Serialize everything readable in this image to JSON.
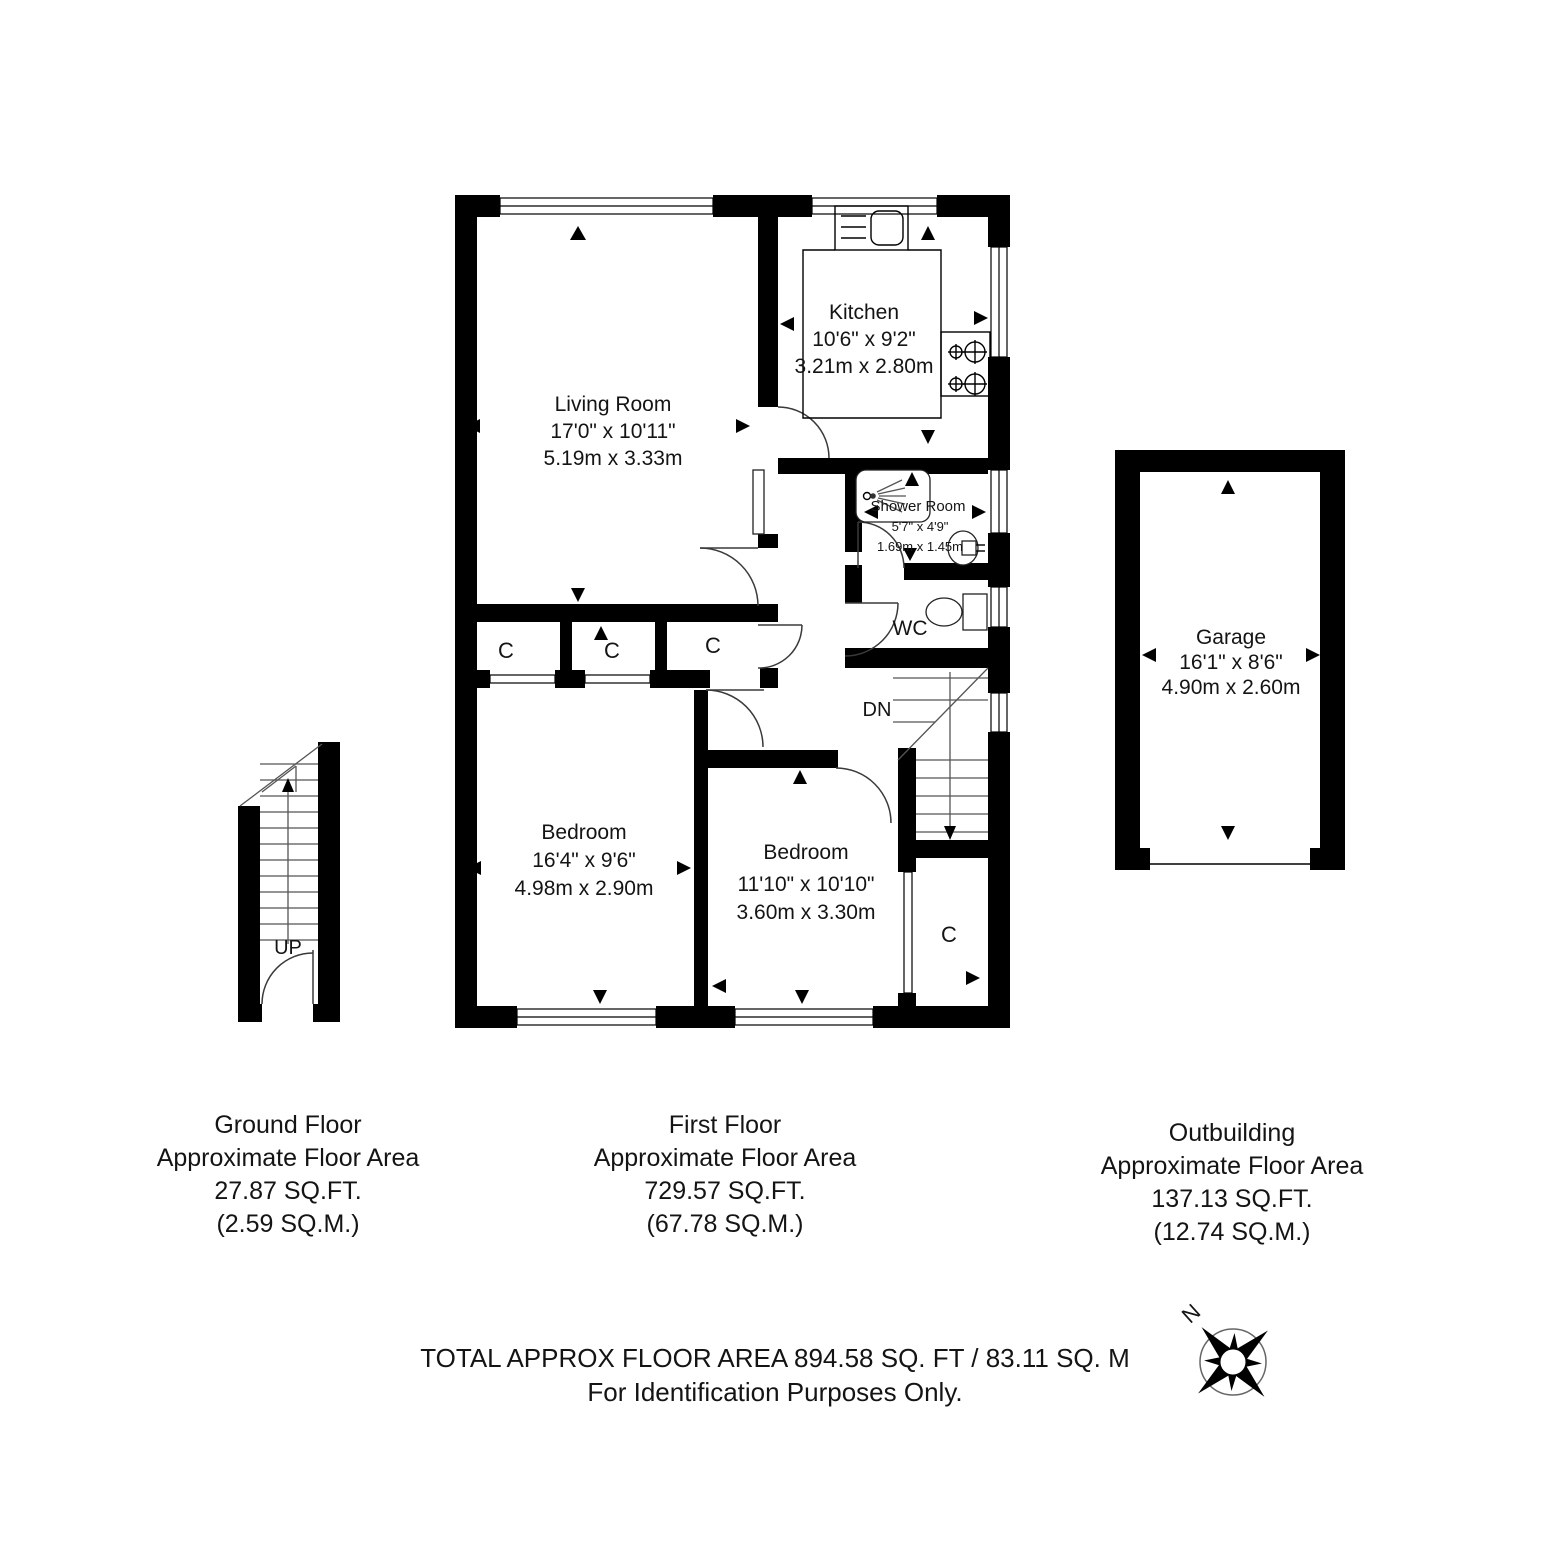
{
  "rooms": {
    "living_room": {
      "name": "Living Room",
      "imperial": "17'0\" x 10'11\"",
      "metric": "5.19m x 3.33m"
    },
    "kitchen": {
      "name": "Kitchen",
      "imperial": "10'6\" x 9'2\"",
      "metric": "3.21m x 2.80m"
    },
    "shower_room": {
      "name": "Shower Room",
      "imperial": "5'7\" x 4'9\"",
      "metric": "1.69m x 1.45m"
    },
    "wc": {
      "name": "WC"
    },
    "bedroom_large": {
      "name": "Bedroom",
      "imperial": "16'4\" x 9'6\"",
      "metric": "4.98m x 2.90m"
    },
    "bedroom_small": {
      "name": "Bedroom",
      "imperial": "11'10\" x 10'10\"",
      "metric": "3.60m x 3.30m"
    },
    "garage": {
      "name": "Garage",
      "imperial": "16'1\" x 8'6\"",
      "metric": "4.90m x 2.60m"
    }
  },
  "labels": {
    "closet": "C",
    "up": "UP",
    "down": "DN",
    "north": "N"
  },
  "areas": {
    "ground_floor": {
      "title": "Ground Floor",
      "line2": "Approximate Floor Area",
      "sqft": "27.87 SQ.FT.",
      "sqm": "(2.59 SQ.M.)"
    },
    "first_floor": {
      "title": "First Floor",
      "line2": "Approximate Floor Area",
      "sqft": "729.57 SQ.FT.",
      "sqm": "(67.78 SQ.M.)"
    },
    "outbuilding": {
      "title": "Outbuilding",
      "line2": "Approximate Floor Area",
      "sqft": "137.13 SQ.FT.",
      "sqm": "(12.74 SQ.M.)"
    }
  },
  "footer": {
    "total": "TOTAL APPROX FLOOR AREA 894.58 SQ. FT / 83.11 SQ. M",
    "disclaimer": "For Identification Purposes Only."
  }
}
